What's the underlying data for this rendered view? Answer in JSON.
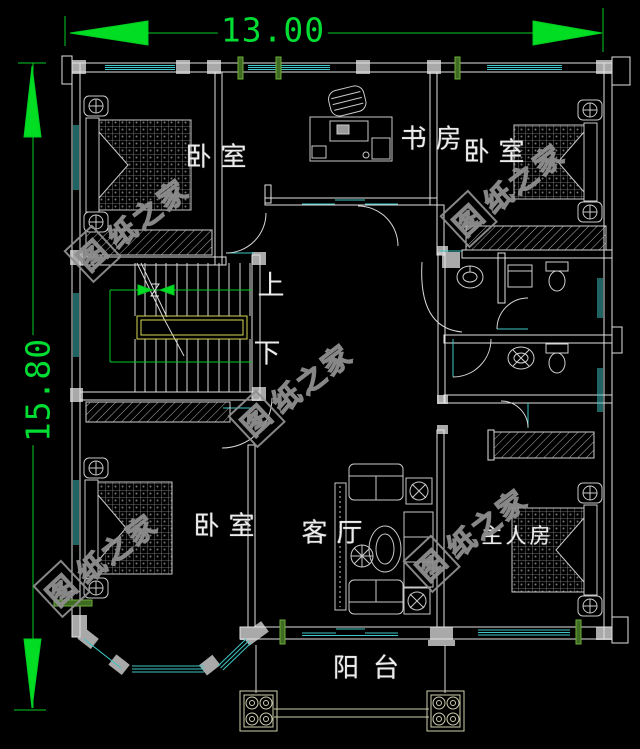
{
  "dimensions": {
    "width_label": "13.00",
    "height_label": "15.80"
  },
  "rooms": {
    "bedroom": "卧室",
    "study": "书房",
    "living": "客厅",
    "master": "主人房",
    "balcony": "阳台"
  },
  "stair": {
    "up": "上",
    "down": "下"
  },
  "watermark": {
    "logo_char": "图",
    "text": "纸之家"
  },
  "colors": {
    "background": "#000000",
    "wall": "#e2e2e2",
    "column_fill": "#a9a9a9",
    "window": "#3fc6c6",
    "dimension_green": "#00dd33",
    "stair_rail_yellow": "#d6d655",
    "watermark_gray": "#8f8f8f",
    "label_white": "#ececec"
  }
}
